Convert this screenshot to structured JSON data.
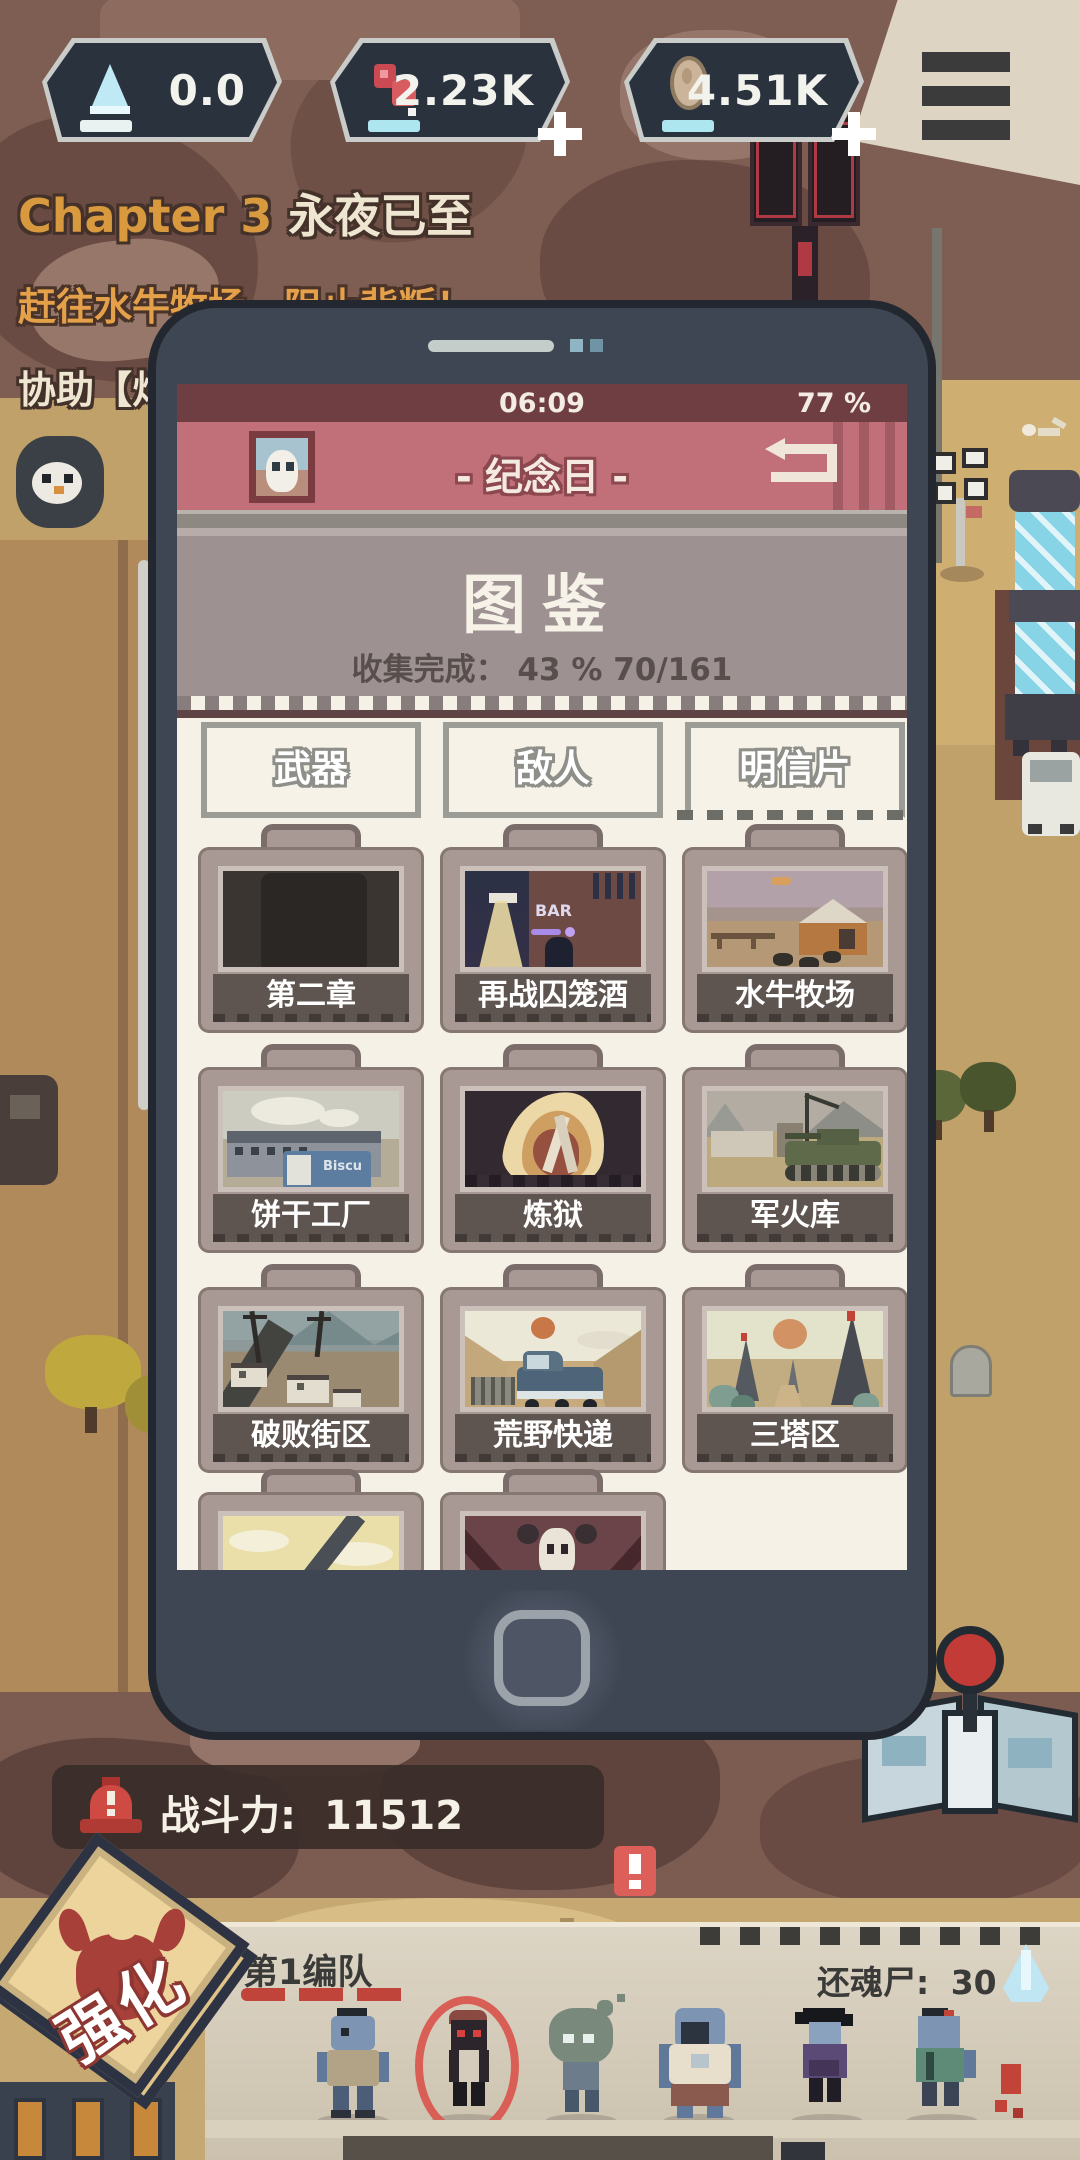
{
  "hud_top": {
    "resources": [
      {
        "name": "fuel",
        "icon": "flask-icon",
        "value": "0.0"
      },
      {
        "name": "meat",
        "icon": "meat-icon",
        "value": "2.23K",
        "add_label": "+"
      },
      {
        "name": "ore",
        "icon": "egg-icon",
        "value": "4.51K",
        "add_label": "+"
      }
    ],
    "menu_icon": "hamburger-menu-icon"
  },
  "quest": {
    "chapter_label": "Chapter 3",
    "chapter_name": "永夜已至",
    "objective_line": "赶往水牛牧场，阻止背叛！",
    "assist_line": "协助【灯"
  },
  "phone": {
    "status_bar": {
      "time": "06:09",
      "battery": "77 %"
    },
    "header": {
      "title": "- 纪念日 -",
      "avatar_icon": "ghost-avatar",
      "back_icon": "return-icon"
    },
    "collection": {
      "title": "图鉴",
      "progress_text": "收集完成： 43 %  70/161"
    },
    "tabs": [
      {
        "label": "武器",
        "selected": false
      },
      {
        "label": "敌人",
        "selected": false
      },
      {
        "label": "明信片",
        "selected": true
      }
    ],
    "postcards": [
      {
        "label": "第二章"
      },
      {
        "label": "再战囚笼酒",
        "sign_text": "BAR"
      },
      {
        "label": "水牛牧场"
      },
      {
        "label": "饼干工厂",
        "sign_text": "Biscu"
      },
      {
        "label": "炼狱"
      },
      {
        "label": "军火库"
      },
      {
        "label": "破败街区"
      },
      {
        "label": "荒野快递"
      },
      {
        "label": "三塔区"
      },
      {
        "label": ""
      },
      {
        "label": ""
      }
    ]
  },
  "hud_bottom": {
    "combat_power_label": "战斗力:",
    "combat_power_value": "11512",
    "enhance_stamp_label": "强化",
    "alert_icon": "exclamation-badge",
    "map_button_icon": "map-joystick-icon",
    "siren_icon": "siren-icon"
  },
  "squad_panel": {
    "squad_name": "第1编队",
    "revenant_label": "还魂尸:",
    "revenant_value": "30",
    "revenant_icon": "crystal-icon",
    "member_count": 6
  },
  "colors": {
    "header_red": "#c1707a",
    "status_red": "#6e3e43",
    "screen_cream": "#f5f1e6",
    "title_mauve": "#9d9192",
    "panel_beige": "#d9d0bf",
    "badge_dark": "#2a323e",
    "accent_red": "#c24438",
    "sand": "#c0a169"
  }
}
